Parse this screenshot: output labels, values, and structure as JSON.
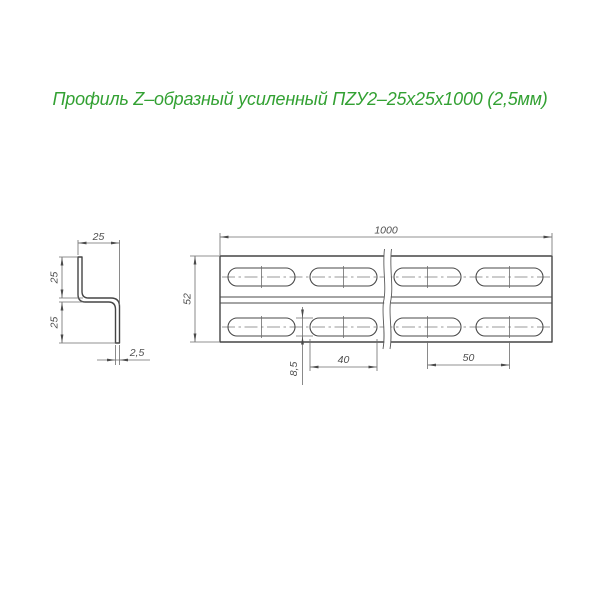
{
  "title": {
    "text": "Профиль Z–образный усиленный ПZУ2–25х25х1000 (2,5мм)",
    "color": "#33a133"
  },
  "colors": {
    "background": "#ffffff",
    "title_green": "#33a133",
    "outline_gray": "#454545",
    "dim_line_gray": "#6c6c6c",
    "dim_text_gray": "#4f4f4f"
  },
  "section_view": {
    "dim_flange_width": "25",
    "dim_upper_height": "25",
    "dim_lower_height": "25",
    "dim_thickness": "2,5"
  },
  "main_view": {
    "dim_length": "1000",
    "dim_height": "52",
    "dim_slot_length": "40",
    "dim_slot_pitch": "50",
    "dim_slot_width": "8,5"
  }
}
